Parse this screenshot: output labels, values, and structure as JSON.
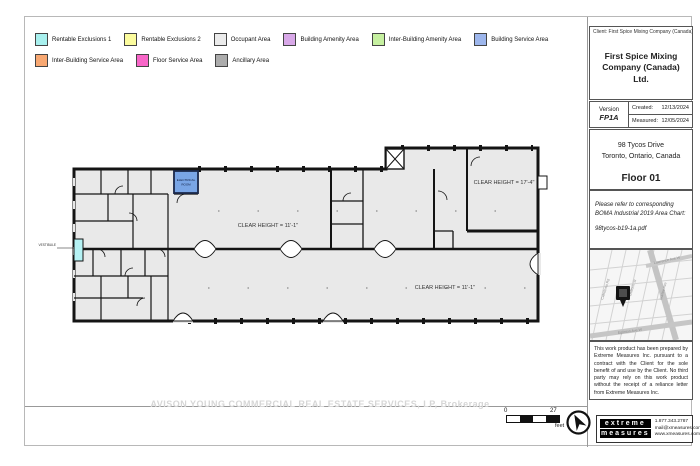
{
  "legend": {
    "row1": [
      {
        "label": "Rentable Exclusions 1",
        "color": "#a8f0ee"
      },
      {
        "label": "Rentable Exclusions 2",
        "color": "#fcfc9e"
      },
      {
        "label": "Occupant Area",
        "color": "#ebebeb"
      },
      {
        "label": "Building Amenity Area",
        "color": "#d8a8e8"
      },
      {
        "label": "Inter-Building Amenity Area",
        "color": "#c6f0a0"
      },
      {
        "label": "Building Service Area",
        "color": "#9db6ec"
      }
    ],
    "row2": [
      {
        "label": "Inter-Building Service Area",
        "color": "#f8a872"
      },
      {
        "label": "Floor Service Area",
        "color": "#f866c8"
      },
      {
        "label": "Ancillary Area",
        "color": "#acacac"
      }
    ]
  },
  "titleblock": {
    "client_line": "Client:  First Spice Mixing Company (Canada) Ltd.",
    "title": "First Spice Mixing Company (Canada) Ltd.",
    "version_label": "Version",
    "version_value": "FP1A",
    "created_label": "Created:",
    "created_value": "12/13/2024",
    "measured_label": "Measured:",
    "measured_value": "12/05/2024",
    "address_line1": "98 Tycos Drive",
    "address_line2": "Toronto, Ontario, Canada",
    "floor_title": "Floor 01",
    "note_line": "Please refer to corresponding BOMA Industrial 2019 Area Chart:",
    "note_file": "98tycos-b19-1a.pdf",
    "disclaimer": "This work product has been prepared by Extreme Measures Inc. pursuant to a contract with the Client for the sole benefit of and use by the Client. No third party may rely on this work product without the receipt of a reliance letter from Extreme Measures Inc."
  },
  "plan": {
    "clear_height_main": "CLEAR HEIGHT = 11'-1\"",
    "clear_height_lower": "CLEAR HEIGHT = 11'-1\"",
    "clear_height_upper_right": "CLEAR HEIGHT = 17'-4\"",
    "electrical_room_line1": "ELECTRICAL",
    "electrical_room_line2": "ROOM",
    "vestibule_label": "VESTIBULE"
  },
  "map": {
    "streets": [
      "Caledonia Rd",
      "Dufferin St",
      "Lawrence Ave W",
      "Marlee Ave",
      "Eglinton Ave W"
    ]
  },
  "footer": {
    "scale_start": "0",
    "scale_end": "27",
    "scale_unit": "feet",
    "logo_line1": "extreme",
    "logo_line2": "measures",
    "phone": "1.877.343.2787",
    "email": "mail@xmeasures.com",
    "web": "www.xmeasures.com"
  },
  "watermark": "AVISON YOUNG COMMERCIAL REAL ESTATE SERVICES, LP, Brokerage"
}
